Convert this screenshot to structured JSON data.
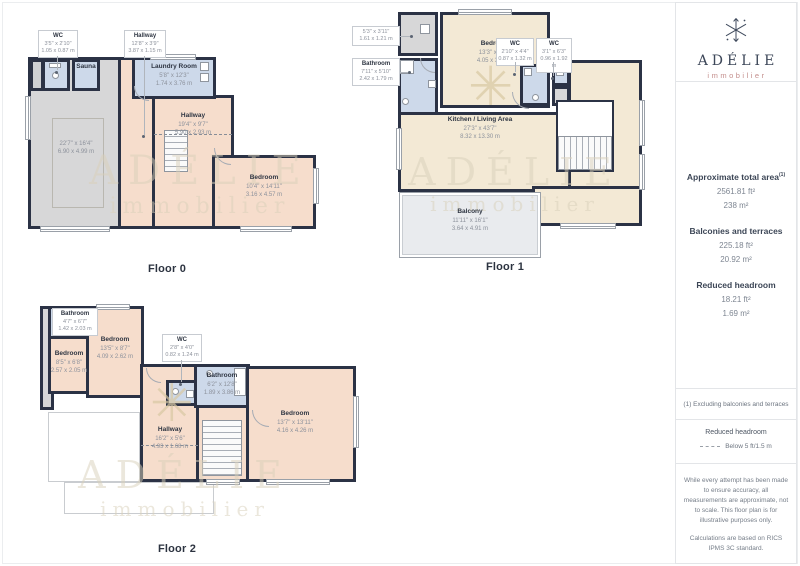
{
  "floor0": {
    "caption": "Floor 0",
    "wc": {
      "name": "WC",
      "ft": "3'5\" x 2'10\"",
      "m": "1.05 x 0.87 m"
    },
    "hallway_top": {
      "name": "Hallway",
      "ft": "12'8\" x 3'9\"",
      "m": "3.87 x 1.15 m"
    },
    "sauna": {
      "name": "Sauna"
    },
    "laundry": {
      "name": "Laundry Room",
      "ft": "5'8\" x 12'3\"",
      "m": "1.74 x 3.76 m"
    },
    "hallway": {
      "name": "Hallway",
      "ft": "19'4\" x 9'7\"",
      "m": "5.90 x 2.93 m"
    },
    "garage": {
      "ft": "22'7\" x 16'4\"",
      "m": "6.90 x 4.99 m"
    },
    "bedroom": {
      "name": "Bedroom",
      "ft": "10'4\" x 14'11\"",
      "m": "3.16 x 4.57 m"
    }
  },
  "floor1": {
    "caption": "Floor 1",
    "storage": {
      "ft": "5'3\" x 3'11\"",
      "m": "1.61 x 1.21 m"
    },
    "bathroom": {
      "name": "Bathroom",
      "ft": "7'11\" x 5'10\"",
      "m": "2.42 x 1.79 m"
    },
    "bedroom": {
      "name": "Bedroom",
      "ft": "13'3\" x 11'1\"",
      "m": "4.05 x 3.40 m"
    },
    "wc1": {
      "name": "WC",
      "ft": "2'10\" x 4'4\"",
      "m": "0.87 x 1.32 m"
    },
    "wc2": {
      "name": "WC",
      "ft": "3'1\" x 6'3\"",
      "m": "0.96 x 1.92 m"
    },
    "kitchen": {
      "name": "Kitchen / Living Area",
      "ft": "27'3\" x 43'7\"",
      "m": "8.32 x 13.30 m"
    },
    "balcony": {
      "name": "Balcony",
      "ft": "11'11\" x 16'1\"",
      "m": "3.64 x 4.91 m"
    }
  },
  "floor2": {
    "caption": "Floor 2",
    "bathroom_a": {
      "name": "Bathroom",
      "ft": "4'7\" x 6'7\"",
      "m": "1.42 x 2.03 m"
    },
    "bedroom_b": {
      "name": "Bedroom",
      "ft": "13'5\" x 8'7\"",
      "m": "4.09 x 2.62 m"
    },
    "bedroom_small": {
      "name": "Bedroom",
      "ft": "8'5\" x 6'8\"",
      "m": "2.57 x 2.05 m"
    },
    "wc": {
      "name": "WC",
      "ft": "2'8\" x 4'0\"",
      "m": "0.82 x 1.24 m"
    },
    "bathroom_c": {
      "name": "Bathroom",
      "ft": "6'2\" x 12'8\"",
      "m": "1.89 x 3.86 m"
    },
    "bedroom_d": {
      "name": "Bedroom",
      "ft": "13'7\" x 13'11\"",
      "m": "4.16 x 4.26 m"
    },
    "hallway": {
      "name": "Hallway",
      "ft": "16'2\" x 5'6\"",
      "m": "4.93 x 1.68 m"
    }
  },
  "watermark": {
    "line1": "ADÉLIE",
    "line2": "immobilier"
  },
  "decor": {
    "palm_icon": "snowflake-burst",
    "palm_glyph": "✳"
  },
  "sidebar": {
    "brand": {
      "icon": "snowflake-icon",
      "name": "ADÉLIE",
      "subtitle": "immobilier"
    },
    "total": {
      "title": "Approximate total area",
      "sup": "(1)",
      "ft": "2561.81 ft²",
      "m": "238 m²"
    },
    "balconies": {
      "title": "Balconies and terraces",
      "ft": "225.18 ft²",
      "m": "20.92 m²"
    },
    "headroom": {
      "title": "Reduced headroom",
      "ft": "18.21 ft²",
      "m": "1.69 m²"
    },
    "footnote": "(1) Excluding balconies and terraces",
    "legend": {
      "title": "Reduced headroom",
      "item": "Below 5 ft/1.5 m"
    },
    "disclaimer1": "While every attempt has been made to ensure accuracy, all measurements are approximate, not to scale. This floor plan is for illustrative purposes only.",
    "disclaimer2": "Calculations are based on RICS IPMS 3C standard.",
    "brand_footer": {
      "name": "GIRAFFE",
      "bold": "360"
    }
  },
  "colors": {
    "wall": "#2b3245",
    "room_salmon": "#f6ddcc",
    "room_cream": "#f3e9d5",
    "room_blue": "#cdd9ea",
    "room_gray": "#d7d7d8",
    "balcony": "#e9ebee",
    "brand_navy": "#3d4759",
    "brand_rose": "#c48f8d"
  }
}
